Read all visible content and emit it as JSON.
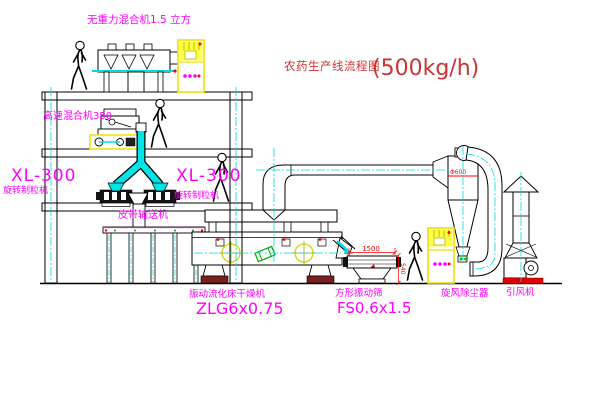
{
  "title": {
    "name": "农药生产线流程图",
    "capacity": "(500kg/h)"
  },
  "labels": {
    "gravity_mixer": "无重力混合机1.5 立方",
    "high_speed_mixer": "高速混合机350",
    "granulator_left": {
      "model": "XL-300",
      "name": "旋转制粒机"
    },
    "granulator_right": {
      "model": "XL-300",
      "name": "旋转制粒机"
    },
    "belt_conveyor": "皮带输送机",
    "dryer": {
      "name": "振动流化床干燥机",
      "model": "ZLG6x0.75"
    },
    "screen": {
      "name": "方形振动筛",
      "model": "FS0.6x1.5"
    },
    "cyclone": "旋风除尘器",
    "fan": "引风机"
  },
  "dims": {
    "screen_length": "1500",
    "screen_height": "540",
    "cyclone_diameter": "Φ600"
  },
  "colors": {
    "label": "#ff00ff",
    "title": "#cc3333",
    "dimension": "#ff0000",
    "centerline": "#00dddd",
    "cabinet": "#f0e000"
  }
}
